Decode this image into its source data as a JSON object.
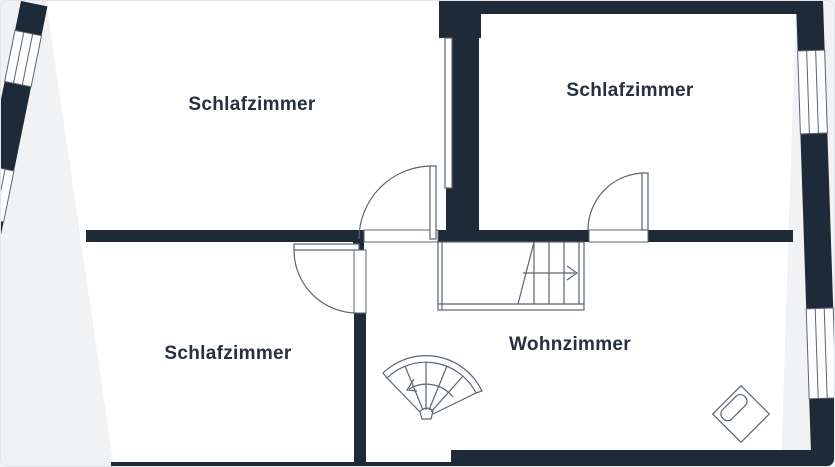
{
  "floorplan": {
    "rooms": [
      {
        "id": "bedroom-top-left",
        "label": "Schlafzimmer"
      },
      {
        "id": "bedroom-top-right",
        "label": "Schlafzimmer"
      },
      {
        "id": "bedroom-bottom-left",
        "label": "Schlafzimmer"
      },
      {
        "id": "living-room",
        "label": "Wohnzimmer"
      }
    ],
    "colors": {
      "background": "#f1f2f4",
      "wall": "#1f2a38",
      "room_fill": "#ffffff",
      "line": "#5b6472",
      "text": "#26303f"
    }
  }
}
